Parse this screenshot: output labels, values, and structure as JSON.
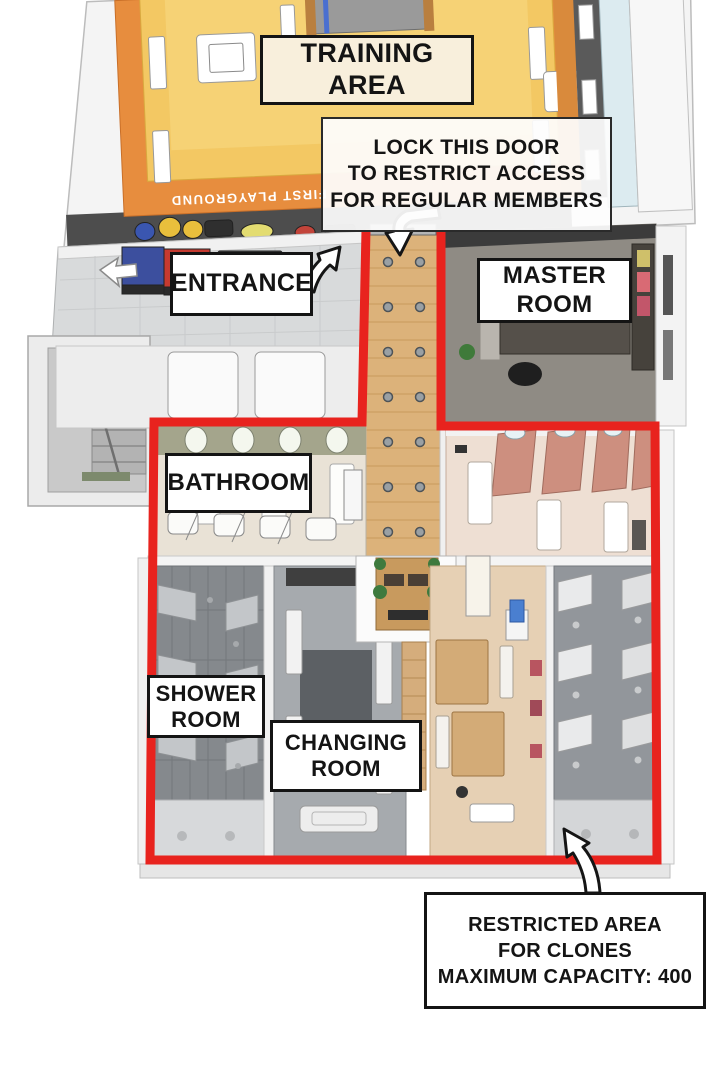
{
  "page": {
    "background": "#ffffff",
    "description": "Isometric cutaway floor plan of a gym facility with annotated rooms and a restricted area outlined in red"
  },
  "labels": {
    "training_area": "TRAINING AREA",
    "lock_door_note": "LOCK THIS DOOR\nTO RESTRICT ACCESS\nFOR REGULAR MEMBERS",
    "entrance": "ENTRANCE",
    "master_room": "MASTER\nROOM",
    "bathroom": "BATHROOM",
    "shower_room": "SHOWER\nROOM",
    "changing_room": "CHANGING\nROOM",
    "restricted_area_note": "RESTRICTED AREA\nFOR CLONES\nMAXIMUM CAPACITY: 400"
  },
  "floor_text": {
    "first_playground": "FIRST PLAYGROUND"
  },
  "icons": {
    "entrance_arrow": "curved-arrow-up-right",
    "door_arrow": "bent-arrow-down-left",
    "restricted_area_arrow": "curved-arrow-up-left"
  },
  "colors": {
    "restricted_boundary": "#e8231e",
    "mat_yellow": "#f3c863",
    "mat_orange": "#e78d3e",
    "corridor_wood": "#dcb27a",
    "label_border": "#141414"
  }
}
